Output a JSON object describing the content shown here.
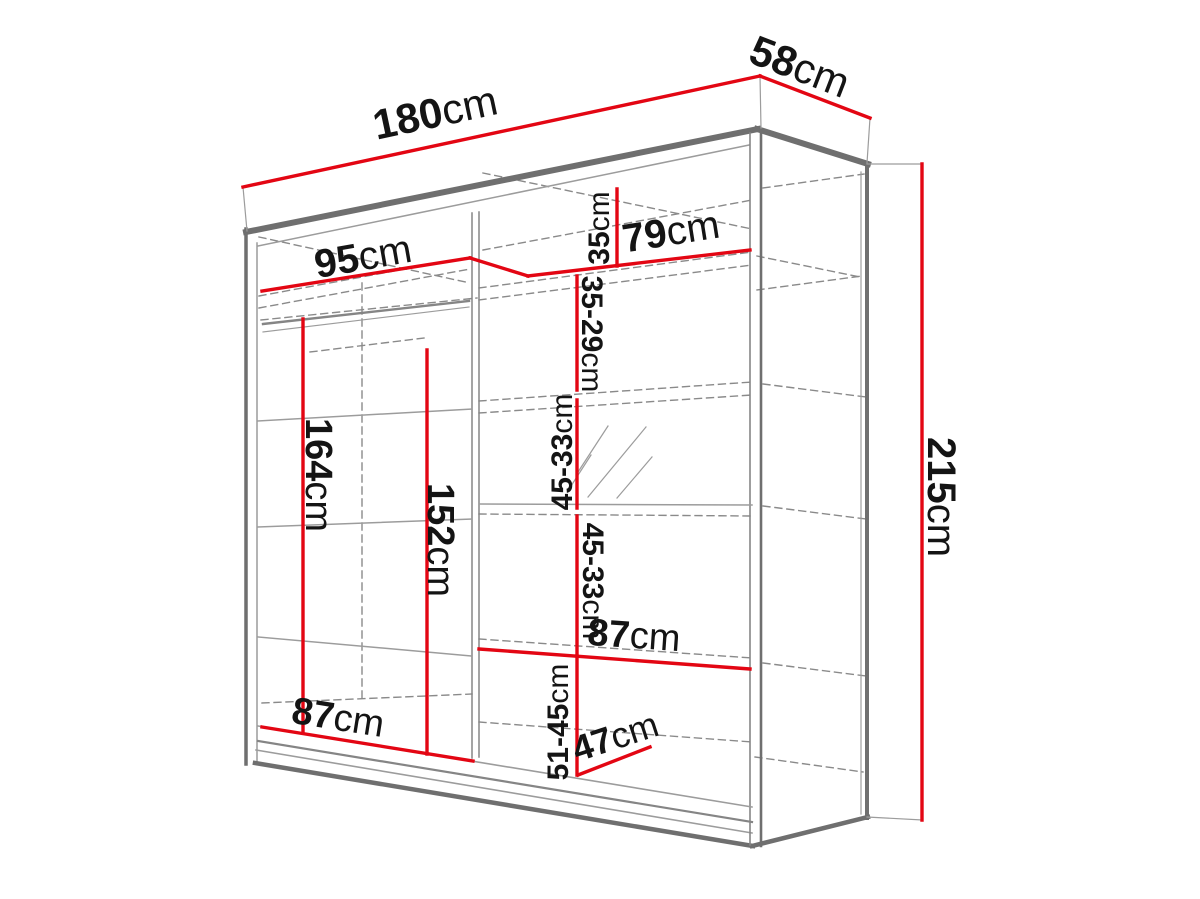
{
  "meta": {
    "description": "Technical dimension diagram of a two-door sliding wardrobe with interior shelves, hanging rails and a mirror",
    "canvas": {
      "width": 1200,
      "height": 899
    }
  },
  "colors": {
    "background": "#ffffff",
    "dimension_red": "#e30613",
    "outline_dark": "#6f6f6f",
    "outline_mid": "#858585",
    "outline_light": "#9c9c9c",
    "dash_gray": "#8a8a8a",
    "label_text": "#141414"
  },
  "dimensions": [
    {
      "id": "width-180",
      "value": "180",
      "unit": "cm",
      "meaning": "overall width"
    },
    {
      "id": "depth-58",
      "value": "58",
      "unit": "cm",
      "meaning": "overall depth"
    },
    {
      "id": "height-215",
      "value": "215",
      "unit": "cm",
      "meaning": "overall height"
    },
    {
      "id": "left-95",
      "value": "95",
      "unit": "cm",
      "meaning": "left section width"
    },
    {
      "id": "right-79",
      "value": "79",
      "unit": "cm",
      "meaning": "right section width"
    },
    {
      "id": "top-35",
      "value": "35",
      "unit": "cm",
      "meaning": "top shelf spacing"
    },
    {
      "id": "gap-35-29",
      "value": "35-29",
      "unit": "cm",
      "meaning": "shelf spacing"
    },
    {
      "id": "gap-45-33-a",
      "value": "45-33",
      "unit": "cm",
      "meaning": "shelf spacing"
    },
    {
      "id": "gap-45-33-b",
      "value": "45-33",
      "unit": "cm",
      "meaning": "shelf spacing"
    },
    {
      "id": "shelf-87-r",
      "value": "87",
      "unit": "cm",
      "meaning": "lower right shelf width"
    },
    {
      "id": "gap-51-45",
      "value": "51-45",
      "unit": "cm",
      "meaning": "bottom compartment height"
    },
    {
      "id": "depth-47",
      "value": "47",
      "unit": "cm",
      "meaning": "interior depth"
    },
    {
      "id": "hang-164",
      "value": "164",
      "unit": "cm",
      "meaning": "left hanging height"
    },
    {
      "id": "hang-152",
      "value": "152",
      "unit": "cm",
      "meaning": "left hanging height 2"
    },
    {
      "id": "bottom-87-l",
      "value": "87",
      "unit": "cm",
      "meaning": "left section bottom width"
    }
  ],
  "labels": [
    {
      "id": "width-180",
      "value": "180",
      "unit": "cm",
      "x": 435,
      "y": 112,
      "rot": -12,
      "size": 42
    },
    {
      "id": "depth-58",
      "value": "58",
      "unit": "cm",
      "x": 800,
      "y": 66,
      "rot": 21,
      "size": 42
    },
    {
      "id": "height-215",
      "value": "215",
      "unit": "cm",
      "x": 941,
      "y": 497,
      "rot": 90,
      "size": 40
    },
    {
      "id": "left-95",
      "value": "95",
      "unit": "cm",
      "x": 363,
      "y": 257,
      "rot": -10,
      "size": 40
    },
    {
      "id": "right-79",
      "value": "79",
      "unit": "cm",
      "x": 671,
      "y": 232,
      "rot": -9,
      "size": 40
    },
    {
      "id": "top-35",
      "value": "35",
      "unit": "cm",
      "x": 599,
      "y": 228,
      "rot": -90,
      "size": 30
    },
    {
      "id": "gap-35-29",
      "value": "35-29",
      "unit": "cm",
      "x": 592,
      "y": 334,
      "rot": 90,
      "size": 30
    },
    {
      "id": "gap-45-33-a",
      "value": "45-33",
      "unit": "cm",
      "x": 562,
      "y": 452,
      "rot": -90,
      "size": 30
    },
    {
      "id": "gap-45-33-b",
      "value": "45-33",
      "unit": "cm",
      "x": 593,
      "y": 581,
      "rot": 90,
      "size": 30
    },
    {
      "id": "shelf-87-r",
      "value": "87",
      "unit": "cm",
      "x": 634,
      "y": 636,
      "rot": 4,
      "size": 38
    },
    {
      "id": "gap-51-45",
      "value": "51-45",
      "unit": "cm",
      "x": 558,
      "y": 722,
      "rot": -90,
      "size": 30
    },
    {
      "id": "depth-47",
      "value": "47",
      "unit": "cm",
      "x": 615,
      "y": 736,
      "rot": -18,
      "size": 36
    },
    {
      "id": "hang-164",
      "value": "164",
      "unit": "cm",
      "x": 318,
      "y": 475,
      "rot": 90,
      "size": 38
    },
    {
      "id": "hang-152",
      "value": "152",
      "unit": "cm",
      "x": 440,
      "y": 540,
      "rot": 90,
      "size": 38
    },
    {
      "id": "bottom-87-l",
      "value": "87",
      "unit": "cm",
      "x": 338,
      "y": 718,
      "rot": 9,
      "size": 38
    }
  ],
  "red_lines": [
    {
      "id": "width-180",
      "pts": [
        243,
        187,
        760,
        76
      ]
    },
    {
      "id": "depth-58",
      "pts": [
        760,
        76,
        870,
        118
      ]
    },
    {
      "id": "height-215",
      "pts": [
        922,
        164,
        922,
        820
      ]
    },
    {
      "id": "left-95",
      "pts": [
        262,
        291,
        470,
        258
      ]
    },
    {
      "id": "elbow-95-79",
      "pts": [
        470,
        258,
        528,
        276
      ]
    },
    {
      "id": "right-79",
      "pts": [
        528,
        276,
        750,
        250
      ]
    },
    {
      "id": "top-35",
      "pts": [
        617,
        189,
        617,
        266
      ]
    },
    {
      "id": "gap-35-29",
      "pts": [
        577,
        276,
        577,
        390
      ]
    },
    {
      "id": "gap-45-33-a",
      "pts": [
        577,
        400,
        577,
        508
      ]
    },
    {
      "id": "gap-45-33-b",
      "pts": [
        577,
        516,
        577,
        653
      ]
    },
    {
      "id": "shelf-87-r",
      "pts": [
        479,
        649,
        750,
        669
      ]
    },
    {
      "id": "gap-51-45",
      "pts": [
        577,
        656,
        577,
        775
      ]
    },
    {
      "id": "depth-47",
      "pts": [
        578,
        775,
        650,
        747
      ]
    },
    {
      "id": "hang-164",
      "pts": [
        303,
        319,
        303,
        733
      ]
    },
    {
      "id": "hang-152",
      "pts": [
        427,
        350,
        427,
        754
      ]
    },
    {
      "id": "bottom-87-l",
      "pts": [
        262,
        727,
        473,
        761
      ]
    }
  ],
  "extension_lines": [
    [
      243,
      187,
      247,
      231
    ],
    [
      760,
      76,
      761,
      128
    ],
    [
      870,
      118,
      867,
      163
    ],
    [
      867,
      164,
      922,
      164
    ],
    [
      867,
      817,
      922,
      820
    ]
  ],
  "solid_lines": [
    {
      "pts": [
        246,
        232,
        758,
        129
      ],
      "w": 6,
      "c": "dark"
    },
    {
      "pts": [
        258,
        246,
        749,
        145
      ],
      "w": 1.5,
      "c": "light"
    },
    {
      "pts": [
        246,
        229,
        246,
        764
      ],
      "w": 3.5,
      "c": "dark"
    },
    {
      "pts": [
        257,
        243,
        257,
        762
      ],
      "w": 1.5,
      "c": "light"
    },
    {
      "pts": [
        757,
        129,
        868,
        164
      ],
      "w": 6,
      "c": "dark"
    },
    {
      "pts": [
        867,
        165,
        867,
        818
      ],
      "w": 4,
      "c": "dark"
    },
    {
      "pts": [
        861,
        172,
        861,
        814
      ],
      "w": 1.2,
      "c": "light"
    },
    {
      "pts": [
        752,
        846,
        868,
        817
      ],
      "w": 4.5,
      "c": "dark"
    },
    {
      "pts": [
        255,
        763,
        753,
        846
      ],
      "w": 4.5,
      "c": "dark"
    },
    {
      "pts": [
        256,
        750,
        752,
        833
      ],
      "w": 1.6,
      "c": "light"
    },
    {
      "pts": [
        750,
        133,
        750,
        845
      ],
      "w": 1.6,
      "c": "mid"
    },
    {
      "pts": [
        761,
        129,
        761,
        846
      ],
      "w": 2.6,
      "c": "dark"
    },
    {
      "pts": [
        472,
        213,
        472,
        758
      ],
      "w": 1.5,
      "c": "mid"
    },
    {
      "pts": [
        479,
        212,
        479,
        757
      ],
      "w": 1.5,
      "c": "mid"
    },
    {
      "pts": [
        263,
        324,
        469,
        301
      ],
      "w": 2.4,
      "c": "mid"
    },
    {
      "pts": [
        263,
        332,
        469,
        307
      ],
      "w": 1.2,
      "c": "light"
    },
    {
      "pts": [
        258,
        421,
        472,
        409
      ],
      "w": 1.5,
      "c": "light"
    },
    {
      "pts": [
        258,
        527,
        472,
        519
      ],
      "w": 1.5,
      "c": "light"
    },
    {
      "pts": [
        258,
        637,
        472,
        656
      ],
      "w": 1.5,
      "c": "light"
    },
    {
      "pts": [
        258,
        726,
        752,
        807
      ],
      "w": 1.6,
      "c": "light"
    },
    {
      "pts": [
        258,
        741,
        752,
        822
      ],
      "w": 2.2,
      "c": "mid"
    },
    {
      "pts": [
        479,
        504,
        752,
        505
      ],
      "w": 1.5,
      "c": "light"
    }
  ],
  "dashed_lines": [
    [
      259,
      237,
      470,
      283
    ],
    [
      483,
      173,
      752,
      229
    ],
    [
      259,
      296,
      470,
      257
    ],
    [
      259,
      308,
      470,
      269
    ],
    [
      483,
      250,
      752,
      200
    ],
    [
      763,
      188,
      864,
      174
    ],
    [
      479,
      288,
      752,
      252
    ],
    [
      479,
      300,
      752,
      265
    ],
    [
      757,
      256,
      860,
      277
    ],
    [
      757,
      290,
      862,
      276
    ],
    [
      261,
      320,
      477,
      298
    ],
    [
      479,
      401,
      752,
      382
    ],
    [
      479,
      413,
      752,
      395
    ],
    [
      763,
      384,
      866,
      397
    ],
    [
      479,
      514,
      752,
      516
    ],
    [
      763,
      506,
      866,
      519
    ],
    [
      479,
      639,
      752,
      658
    ],
    [
      763,
      663,
      866,
      676
    ],
    [
      262,
      703,
      472,
      694
    ],
    [
      479,
      722,
      752,
      742
    ],
    [
      755,
      757,
      863,
      772
    ],
    [
      362,
      283,
      362,
      700
    ],
    [
      310,
      352,
      424,
      338
    ]
  ],
  "hatch_lines": [
    [
      578,
      472,
      608,
      426
    ],
    [
      588,
      497,
      646,
      427
    ],
    [
      617,
      498,
      652,
      457
    ],
    [
      571,
      486,
      591,
      455
    ]
  ]
}
